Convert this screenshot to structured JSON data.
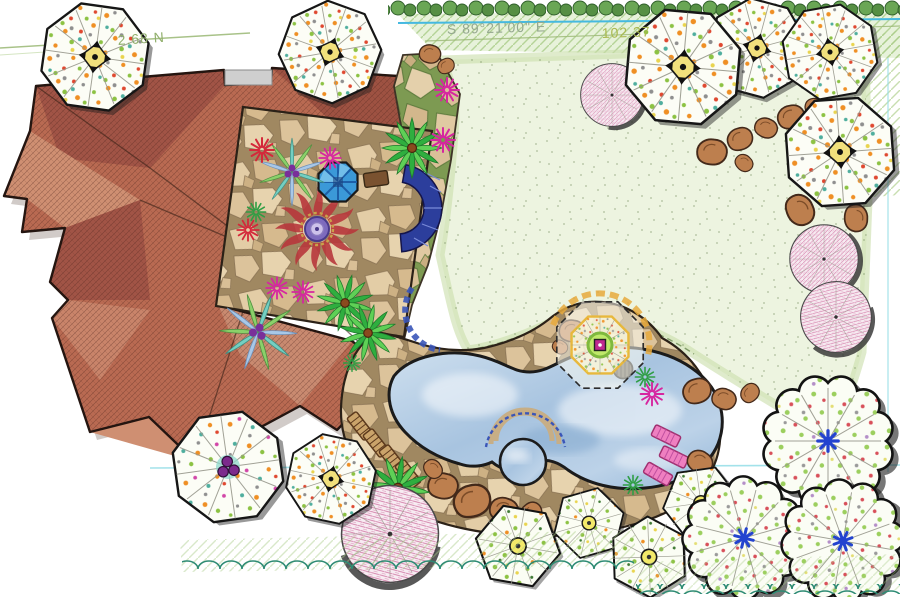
{
  "title": "Residential landscape master plan",
  "survey": {
    "left_distance": "2.68 N",
    "bearing": "S 89°21'00\" E",
    "distance": "102.37"
  },
  "palette": {
    "roof": "#b96a52",
    "roof_dark": "#a15446",
    "roof_light": "#cf8f72",
    "flagstone": "#d9c09a",
    "pool_water": "#aac6e2",
    "lawn": "#edf4e0",
    "hedge": "#5f9e4c",
    "tile_blue": "#2c3e9c",
    "accent_magenta": "#d238a4",
    "survey_green": "#9ab874",
    "survey_cyan": "#45b9e0"
  },
  "features": [
    {
      "name": "house-roof",
      "label": "house with terracotta hip roof"
    },
    {
      "name": "courtyard-patio",
      "label": "flagstone courtyard patio"
    },
    {
      "name": "sun-mosaic",
      "label": "sun mosaic inlay"
    },
    {
      "name": "spa-octagon",
      "label": "octagonal courtyard spa"
    },
    {
      "name": "seat-wall",
      "label": "curved blue tile seat wall"
    },
    {
      "name": "walkway",
      "label": "flagstone garden walkway"
    },
    {
      "name": "lawn",
      "label": "open lawn"
    },
    {
      "name": "pool-deck",
      "label": "free-form flagstone pool deck"
    },
    {
      "name": "swimming-pool",
      "label": "free-form swimming pool"
    },
    {
      "name": "pool-spa",
      "label": "round raised spa"
    },
    {
      "name": "lounge-chairs",
      "label": "wood lounge chairs"
    },
    {
      "name": "pink-loungers",
      "label": "pink lounge chairs"
    },
    {
      "name": "boulders",
      "label": "boulder groupings"
    },
    {
      "name": "shade-trees",
      "label": "deciduous shade trees"
    },
    {
      "name": "ornamental-trees",
      "label": "ornamental flowering trees"
    },
    {
      "name": "hedges",
      "label": "clipped evergreen hedges"
    }
  ]
}
